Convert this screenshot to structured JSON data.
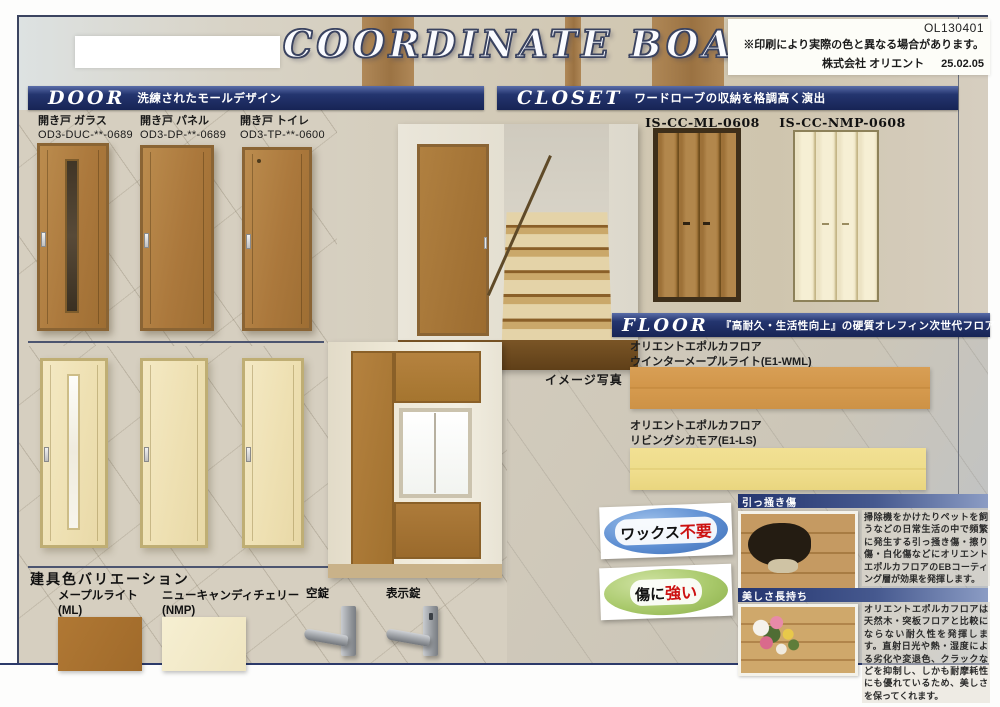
{
  "page": {
    "title": "COORDINATE  BOARD",
    "code": "OL130401",
    "disclaimer": "※印刷により実際の色と異なる場合があります。",
    "company": "株式会社 オリエント",
    "date": "25.02.05",
    "accent_color": "#24356f"
  },
  "door": {
    "title": "DOOR",
    "subtitle": "洗練されたモールデザイン",
    "products": [
      {
        "name": "開き戸 ガラス",
        "code": "OD3-DUC-**-0689"
      },
      {
        "name": "開き戸 パネル",
        "code": "OD3-DP-**-0689"
      },
      {
        "name": "開き戸 トイレ",
        "code": "OD3-TP-**-0600"
      }
    ]
  },
  "closet": {
    "title": "CLOSET",
    "subtitle": "ワードローブの収納を格調高く演出",
    "products": [
      {
        "code": "IS-CC-ML-0608",
        "color": "#a5783c"
      },
      {
        "code": "IS-CC-NMP-0608",
        "color": "#f1e9cc"
      }
    ]
  },
  "floor": {
    "title": "FLOOR",
    "subtitle": "『高耐久・生活性向上』の硬質オレフィン次世代フロア",
    "products": [
      {
        "brand": "オリエントエポルカフロア",
        "name": "ウインターメープルライト(E1-WML)",
        "color": "#d2964a"
      },
      {
        "brand": "オリエントエポルカフロア",
        "name": "リビングシカモア(E1-LS)",
        "color": "#eedd8c"
      }
    ]
  },
  "variation": {
    "title": "建具色バリエーション",
    "swatches": [
      {
        "name": "メープルライト",
        "code": "(ML)",
        "color": "#a9712f"
      },
      {
        "name": "ニューキャンディチェリー",
        "code": "(NMP)",
        "color": "#f4edd0"
      }
    ],
    "locks": [
      {
        "label": "空錠"
      },
      {
        "label": "表示錠"
      }
    ]
  },
  "badges": [
    {
      "black": "ワックス",
      "red": "不要",
      "color": "#5d8ed2"
    },
    {
      "black": "傷に",
      "red": "強い",
      "color": "#a9c96b"
    }
  ],
  "features": [
    {
      "title": "引っ掻き傷",
      "text": "掃除機をかけたりペットを飼うなどの日常生活の中で頻繁に発生する引っ掻き傷・擦り傷・白化傷などにオリエントエポルカフロアのEBコーティング層が効果を発揮します。"
    },
    {
      "title": "美しさ長持ち",
      "text": "オリエントエポルカフロアは天然木・突板フロアと比較にならない耐久性を発揮します。直射日光や熱・湿度による劣化や変退色、クラックなどを抑制し、しかも耐摩耗性にも優れているため、美しさを保ってくれます。"
    }
  ],
  "caption": {
    "image_photo": "イメージ写真"
  }
}
